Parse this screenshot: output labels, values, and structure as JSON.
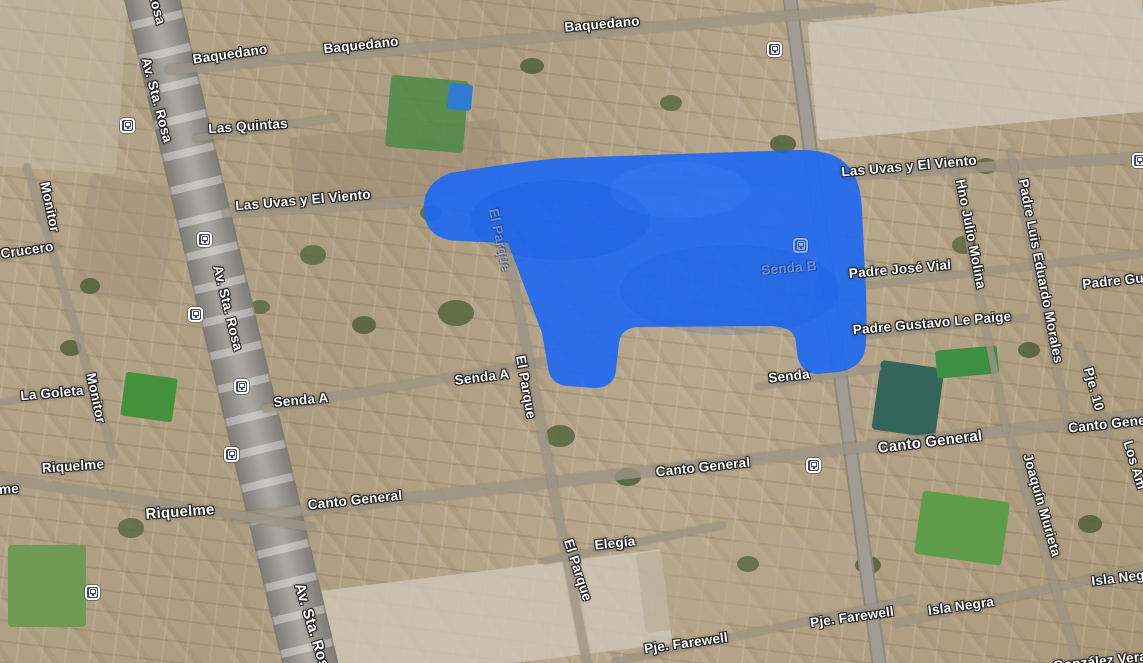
{
  "map": {
    "kind": "satellite-map-with-highlight",
    "highlight": {
      "color": "#1d68f3",
      "opacity": 0.9,
      "path": "M450,173 C492,166 527,161 562,158 L798,150 Q834,149 849,167 Q861,182 862,210 L866,292 Q867,326 866,342 Q865,369 837,372 L818,374 Q799,374 797,352 Q796,342 795,338 Q792,327 771,326 L641,327 Q621,327 619,343 L616,370 Q614,388 594,388 L567,386 Q550,384 548,367 L542,333 L508,243 L459,241 Q427,240 424,213 Q421,184 450,173 Z"
    },
    "labels": [
      {
        "text": "Baquedano",
        "x": 230,
        "y": 54,
        "rot": -8
      },
      {
        "text": "Baquedano",
        "x": 361,
        "y": 45,
        "rot": -6
      },
      {
        "text": "Baquedano",
        "x": 602,
        "y": 24,
        "rot": -5
      },
      {
        "text": "Las Quintas",
        "x": 248,
        "y": 126,
        "rot": -4
      },
      {
        "text": "Las Uvas y El Viento",
        "x": 303,
        "y": 200,
        "rot": -5
      },
      {
        "text": "Las Uvas y El Viento",
        "x": 909,
        "y": 166,
        "rot": -5
      },
      {
        "text": "Crucero",
        "x": 27,
        "y": 250,
        "rot": -8
      },
      {
        "text": "Monitor",
        "x": 50,
        "y": 207,
        "rot": 78
      },
      {
        "text": "Monitor",
        "x": 96,
        "y": 398,
        "rot": 78
      },
      {
        "text": "La Goleta",
        "x": 52,
        "y": 393,
        "rot": -5
      },
      {
        "text": "Riquelme",
        "x": 73,
        "y": 466,
        "rot": -4
      },
      {
        "text": "me",
        "x": 9,
        "y": 489,
        "rot": -4
      },
      {
        "text": "Riquelme",
        "x": 180,
        "y": 512,
        "rot": -4,
        "size": 15
      },
      {
        "text": "Av. Sta. Rosa",
        "x": 150,
        "y": -18,
        "rot": 75
      },
      {
        "text": "Av. Sta. Rosa",
        "x": 157,
        "y": 100,
        "rot": 75
      },
      {
        "text": "Av. Sta. Rosa",
        "x": 228,
        "y": 308,
        "rot": 76
      },
      {
        "text": "Av. Sta. Rosa",
        "x": 313,
        "y": 630,
        "rot": 73,
        "size": 15
      },
      {
        "text": "Senda A",
        "x": 301,
        "y": 400,
        "rot": -5
      },
      {
        "text": "Senda A",
        "x": 482,
        "y": 377,
        "rot": -7
      },
      {
        "text": "El Parque",
        "x": 500,
        "y": 240,
        "rot": 78,
        "faint": true
      },
      {
        "text": "El Parque",
        "x": 526,
        "y": 387,
        "rot": 80
      },
      {
        "text": "El Parque",
        "x": 578,
        "y": 570,
        "rot": 72
      },
      {
        "text": "Senda B",
        "x": 789,
        "y": 268,
        "rot": -5,
        "faint": true
      },
      {
        "text": "Senda",
        "x": 789,
        "y": 376,
        "rot": -6
      },
      {
        "text": "Canto General",
        "x": 355,
        "y": 500,
        "rot": -6
      },
      {
        "text": "Canto General",
        "x": 703,
        "y": 467,
        "rot": -6
      },
      {
        "text": "Canto General",
        "x": 930,
        "y": 442,
        "rot": -7,
        "size": 15
      },
      {
        "text": "Canto Gene",
        "x": 1107,
        "y": 424,
        "rot": -6
      },
      {
        "text": "Padre José Vial",
        "x": 900,
        "y": 269,
        "rot": -5
      },
      {
        "text": "Padre Gustavo Le Paige",
        "x": 932,
        "y": 323,
        "rot": -5
      },
      {
        "text": "Padre Gu",
        "x": 1113,
        "y": 281,
        "rot": -6
      },
      {
        "text": "Hno Julio Molina",
        "x": 971,
        "y": 234,
        "rot": 79
      },
      {
        "text": "Padre Luis Eduardo Morales",
        "x": 1041,
        "y": 271,
        "rot": 79
      },
      {
        "text": "Pje. 10",
        "x": 1094,
        "y": 389,
        "rot": 75
      },
      {
        "text": "Los Am",
        "x": 1135,
        "y": 465,
        "rot": 73
      },
      {
        "text": "Joaquín Murieta",
        "x": 1042,
        "y": 505,
        "rot": 74
      },
      {
        "text": "Elegía",
        "x": 615,
        "y": 543,
        "rot": -6
      },
      {
        "text": "Isla Negra",
        "x": 961,
        "y": 606,
        "rot": -8
      },
      {
        "text": "Isla Neg",
        "x": 1118,
        "y": 578,
        "rot": -7
      },
      {
        "text": "Pje. Farewell",
        "x": 686,
        "y": 643,
        "rot": -8
      },
      {
        "text": "Pje. Farewell",
        "x": 852,
        "y": 617,
        "rot": -8
      },
      {
        "text": "González Vera",
        "x": 1100,
        "y": 661,
        "rot": -6
      }
    ],
    "transit_stops": [
      {
        "x": 128,
        "y": 126
      },
      {
        "x": 205,
        "y": 240
      },
      {
        "x": 196,
        "y": 315
      },
      {
        "x": 242,
        "y": 387
      },
      {
        "x": 232,
        "y": 455
      },
      {
        "x": 93,
        "y": 593
      },
      {
        "x": 775,
        "y": 50
      },
      {
        "x": 814,
        "y": 466
      },
      {
        "x": 1140,
        "y": 161
      },
      {
        "x": 801,
        "y": 246,
        "tinted": true
      }
    ],
    "roads": [
      {
        "x1": 150,
        "y1": -10,
        "x2": 312,
        "y2": 670,
        "w": 55,
        "cls": "avenue"
      },
      {
        "x1": 789,
        "y1": -10,
        "x2": 880,
        "y2": 670,
        "w": 15,
        "cls": "major"
      },
      {
        "x1": 165,
        "y1": 70,
        "x2": 875,
        "y2": 8,
        "w": 10,
        "cls": "minor"
      },
      {
        "x1": 222,
        "y1": 213,
        "x2": 1148,
        "y2": 157,
        "w": 10,
        "cls": "minor"
      },
      {
        "x1": 232,
        "y1": 518,
        "x2": 1148,
        "y2": 414,
        "w": 11,
        "cls": "minor"
      },
      {
        "x1": -5,
        "y1": 477,
        "x2": 315,
        "y2": 527,
        "w": 9,
        "cls": "minor"
      },
      {
        "x1": 262,
        "y1": 409,
        "x2": 548,
        "y2": 361,
        "w": 8,
        "cls": "minor"
      },
      {
        "x1": 490,
        "y1": 158,
        "x2": 588,
        "y2": 668,
        "w": 9,
        "cls": "minor"
      },
      {
        "x1": 542,
        "y1": 561,
        "x2": 725,
        "y2": 524,
        "w": 7,
        "cls": "minor"
      },
      {
        "x1": 612,
        "y1": 662,
        "x2": 915,
        "y2": 598,
        "w": 7,
        "cls": "minor"
      },
      {
        "x1": 893,
        "y1": 624,
        "x2": 1148,
        "y2": 566,
        "w": 8,
        "cls": "minor"
      },
      {
        "x1": 848,
        "y1": 287,
        "x2": 1148,
        "y2": 252,
        "w": 7,
        "cls": "minor"
      },
      {
        "x1": 850,
        "y1": 338,
        "x2": 1030,
        "y2": 317,
        "w": 6,
        "cls": "minor"
      },
      {
        "x1": 950,
        "y1": 148,
        "x2": 1007,
        "y2": 432,
        "w": 7,
        "cls": "minor"
      },
      {
        "x1": 1010,
        "y1": 148,
        "x2": 1070,
        "y2": 432,
        "w": 7,
        "cls": "minor"
      },
      {
        "x1": 1078,
        "y1": 342,
        "x2": 1110,
        "y2": 438,
        "w": 6,
        "cls": "minor"
      },
      {
        "x1": 1010,
        "y1": 438,
        "x2": 1080,
        "y2": 668,
        "w": 8,
        "cls": "minor"
      },
      {
        "x1": 26,
        "y1": 163,
        "x2": 114,
        "y2": 457,
        "w": 7,
        "cls": "minor"
      },
      {
        "x1": 193,
        "y1": 138,
        "x2": 338,
        "y2": 117,
        "w": 7,
        "cls": "minor"
      },
      {
        "x1": -5,
        "y1": 259,
        "x2": 60,
        "y2": 246,
        "w": 6,
        "cls": "minor"
      },
      {
        "x1": -5,
        "y1": 403,
        "x2": 98,
        "y2": 387,
        "w": 6,
        "cls": "minor"
      },
      {
        "x1": 755,
        "y1": 387,
        "x2": 882,
        "y2": 368,
        "w": 6,
        "cls": "minor"
      }
    ],
    "patches": [
      {
        "x": 812,
        "y": 8,
        "w": 335,
        "h": 118,
        "c": "#d0cabe",
        "rot": -5,
        "op": 0.75,
        "r": 4
      },
      {
        "x": 288,
        "y": 572,
        "w": 380,
        "h": 95,
        "c": "#cfc7b8",
        "rot": -7,
        "op": 0.8,
        "r": 4
      },
      {
        "x": -8,
        "y": -5,
        "w": 130,
        "h": 175,
        "c": "#c3b9a7",
        "rot": 4,
        "op": 0.55,
        "r": 4
      },
      {
        "x": 80,
        "y": 180,
        "w": 90,
        "h": 120,
        "c": "#9d9079",
        "rot": 10,
        "op": 0.5,
        "r": 4
      },
      {
        "x": 292,
        "y": 128,
        "w": 210,
        "h": 70,
        "c": "#998a74",
        "rot": -5,
        "op": 0.5,
        "r": 4
      },
      {
        "x": 640,
        "y": 540,
        "w": 220,
        "h": 80,
        "c": "#b3a68f",
        "rot": -7,
        "op": 0.5,
        "r": 4
      },
      {
        "x": 388,
        "y": 78,
        "w": 78,
        "h": 72,
        "c": "#4c8a48",
        "rot": 5,
        "op": 0.85,
        "r": 4
      },
      {
        "x": 448,
        "y": 84,
        "w": 24,
        "h": 26,
        "c": "#2f7bd0",
        "rot": 5,
        "op": 1,
        "r": 3
      },
      {
        "x": 123,
        "y": 375,
        "w": 52,
        "h": 44,
        "c": "#44913c",
        "rot": 8,
        "op": 1,
        "r": 3
      },
      {
        "x": 8,
        "y": 545,
        "w": 78,
        "h": 82,
        "c": "#6f9a55",
        "rot": 0,
        "op": 1,
        "r": 4
      },
      {
        "x": 876,
        "y": 364,
        "w": 64,
        "h": 70,
        "c": "#33655a",
        "rot": 8,
        "op": 1,
        "r": 4
      },
      {
        "x": 936,
        "y": 348,
        "w": 62,
        "h": 28,
        "c": "#3f8f42",
        "rot": -5,
        "op": 1,
        "r": 3
      },
      {
        "x": 918,
        "y": 496,
        "w": 88,
        "h": 64,
        "c": "#5f9c49",
        "rot": 8,
        "op": 1,
        "r": 4
      },
      {
        "x": 438,
        "y": 300,
        "w": 36,
        "h": 26,
        "c": "#55663c",
        "rot": 0,
        "op": 0.85,
        "r": 50
      },
      {
        "x": 300,
        "y": 245,
        "w": 26,
        "h": 20,
        "c": "#55663c",
        "rot": 0,
        "op": 0.8,
        "r": 50
      },
      {
        "x": 352,
        "y": 316,
        "w": 24,
        "h": 18,
        "c": "#4b5c33",
        "rot": 0,
        "op": 0.8,
        "r": 50
      },
      {
        "x": 545,
        "y": 425,
        "w": 30,
        "h": 22,
        "c": "#55663c",
        "rot": 0,
        "op": 0.85,
        "r": 50
      },
      {
        "x": 615,
        "y": 468,
        "w": 26,
        "h": 18,
        "c": "#4b5c33",
        "rot": 0,
        "op": 0.8,
        "r": 50
      },
      {
        "x": 420,
        "y": 205,
        "w": 22,
        "h": 16,
        "c": "#55663c",
        "rot": 0,
        "op": 0.8,
        "r": 50
      },
      {
        "x": 770,
        "y": 135,
        "w": 26,
        "h": 18,
        "c": "#4b5c33",
        "rot": 0,
        "op": 0.8,
        "r": 50
      },
      {
        "x": 952,
        "y": 236,
        "w": 24,
        "h": 18,
        "c": "#55663c",
        "rot": 0,
        "op": 0.8,
        "r": 50
      },
      {
        "x": 1018,
        "y": 342,
        "w": 22,
        "h": 16,
        "c": "#4b5c33",
        "rot": 0,
        "op": 0.8,
        "r": 50
      },
      {
        "x": 172,
        "y": 88,
        "w": 24,
        "h": 18,
        "c": "#55663c",
        "rot": 0,
        "op": 0.8,
        "r": 50
      },
      {
        "x": 80,
        "y": 278,
        "w": 20,
        "h": 16,
        "c": "#4b5c33",
        "rot": 0,
        "op": 0.8,
        "r": 50
      },
      {
        "x": 118,
        "y": 518,
        "w": 26,
        "h": 20,
        "c": "#55663c",
        "rot": 0,
        "op": 0.8,
        "r": 50
      },
      {
        "x": 1078,
        "y": 515,
        "w": 24,
        "h": 18,
        "c": "#4b5c33",
        "rot": 0,
        "op": 0.8,
        "r": 50
      },
      {
        "x": 975,
        "y": 158,
        "w": 22,
        "h": 16,
        "c": "#55663c",
        "rot": 0,
        "op": 0.8,
        "r": 50
      },
      {
        "x": 855,
        "y": 556,
        "w": 26,
        "h": 18,
        "c": "#4b5c33",
        "rot": 0,
        "op": 0.8,
        "r": 50
      },
      {
        "x": 737,
        "y": 556,
        "w": 22,
        "h": 16,
        "c": "#55663c",
        "rot": 0,
        "op": 0.8,
        "r": 50
      },
      {
        "x": 520,
        "y": 58,
        "w": 24,
        "h": 16,
        "c": "#4b5c33",
        "rot": 0,
        "op": 0.8,
        "r": 50
      },
      {
        "x": 660,
        "y": 95,
        "w": 22,
        "h": 16,
        "c": "#55663c",
        "rot": 0,
        "op": 0.8,
        "r": 50
      },
      {
        "x": 60,
        "y": 340,
        "w": 22,
        "h": 16,
        "c": "#4b5c33",
        "rot": 0,
        "op": 0.8,
        "r": 50
      },
      {
        "x": 250,
        "y": 300,
        "w": 20,
        "h": 14,
        "c": "#55663c",
        "rot": 0,
        "op": 0.8,
        "r": 50
      }
    ]
  }
}
